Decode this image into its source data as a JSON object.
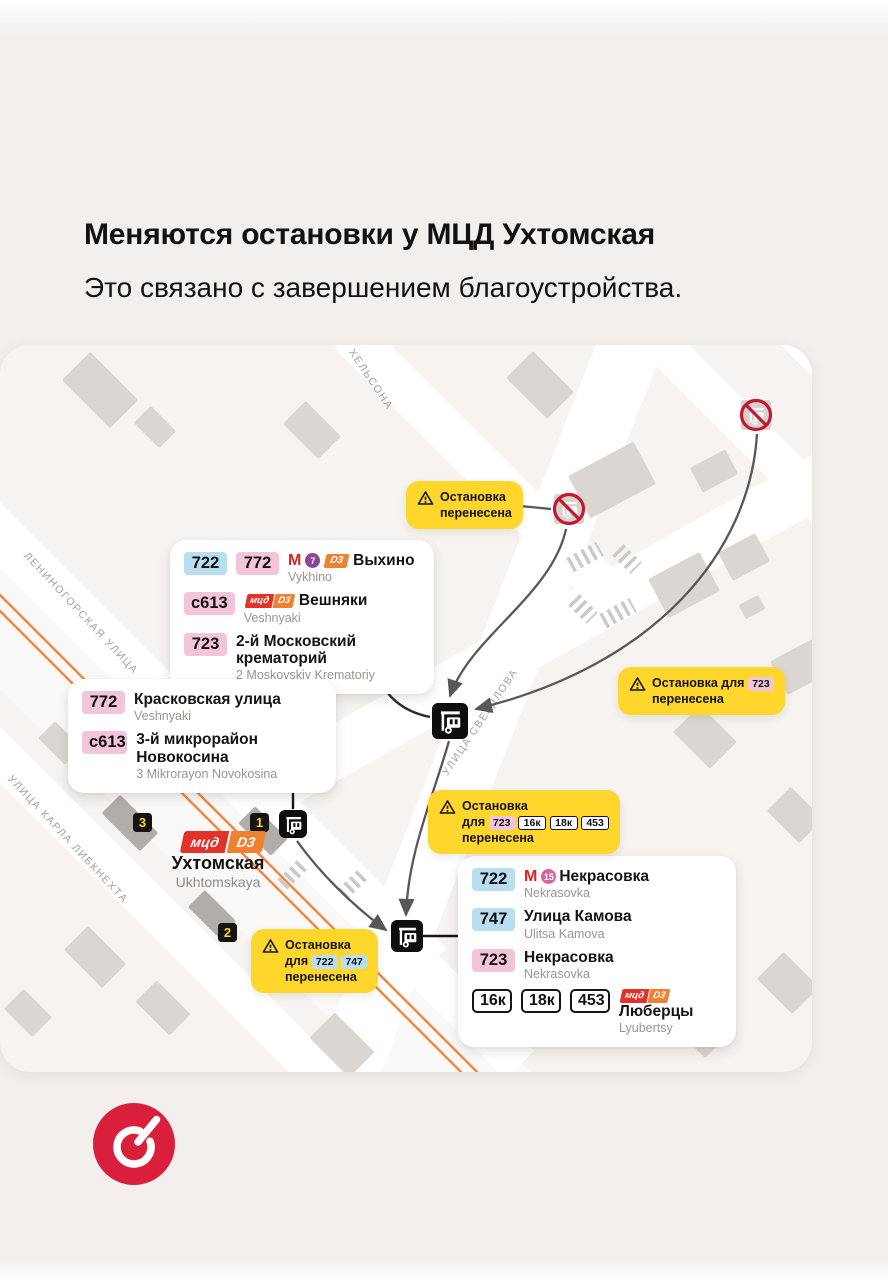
{
  "colors": {
    "yellow": "#ffd62b",
    "badge_blue": "#b9ddf1",
    "badge_pink": "#f3c5da",
    "metro_red": "#e0211f",
    "line7_purple": "#8d4796",
    "line15_pink": "#d9639f",
    "mcd_red": "#e2332b",
    "d3_orange": "#ee8230",
    "railway_orange": "#ef8740",
    "arrow_gray": "#5a5856",
    "logo_red": "#d91f3c"
  },
  "page": {
    "title": "Меняются остановки у МЦД Ухтомская",
    "subtitle": "Это связано с завершением благоустройства."
  },
  "metro": {
    "m": "М"
  },
  "station": {
    "mcd": "мцд",
    "line": "D3",
    "name": "Ухтомская",
    "name_latin": "Ukhtomskaya"
  },
  "markers": {
    "m1": "1",
    "m2": "2",
    "m3": "3"
  },
  "streets": {
    "leninogorskaya": "ЛЕНИНОГОРСКАЯ УЛИЦА",
    "karla_libknehta": "УЛИЦА КАРЛА ЛИБКНЕХТА",
    "khelsona": "ХЕЛЬСОНА",
    "sverdlova": "УЛИЦА СВЕРДЛОВА"
  },
  "callouts": {
    "vykhino": {
      "rows": [
        {
          "badge1": "722",
          "badge2": "772",
          "line_num": "7",
          "d3": "D3",
          "title": "Выхино",
          "sub": "Vykhino"
        },
        {
          "badge1": "с613",
          "mcd": "мцд",
          "d3": "D3",
          "title": "Вешняки",
          "sub": "Veshnyaki"
        },
        {
          "badge1": "723",
          "title": "2-й Московский крематорий",
          "sub": "2 Moskovskiy Krematoriy"
        }
      ]
    },
    "kraskovskaya": {
      "rows": [
        {
          "badge1": "772",
          "title": "Красковская улица",
          "sub": "Veshnyaki"
        },
        {
          "badge1": "с613",
          "title": "3-й микрорайон Новокосина",
          "sub": "3 Mikrorayon Novokosina"
        }
      ]
    },
    "nekrasovka": {
      "rows": [
        {
          "badge1": "722",
          "line_num": "15",
          "title": "Некрасовка",
          "sub": "Nekrasovka"
        },
        {
          "badge1": "747",
          "title": "Улица Камова",
          "sub": "Ulitsa Kamova"
        },
        {
          "badge1": "723",
          "title": "Некрасовка",
          "sub": "Nekrasovka"
        },
        {
          "badge1": "16к",
          "badge2": "18к",
          "badge3": "453",
          "mcd": "мцд",
          "d3": "D3",
          "title": "Люберцы",
          "sub": "Lyubertsy"
        }
      ]
    }
  },
  "warnings": {
    "w1": {
      "line1": "Остановка",
      "line2": "перенесена"
    },
    "w2": {
      "line1": "Остановка для",
      "badge1": "723",
      "line2": "перенесена"
    },
    "w3": {
      "line1": "Остановка",
      "pre": "для",
      "badge1": "723",
      "badge2": "16к",
      "badge3": "18к",
      "badge4": "453",
      "line3": "перенесена"
    },
    "w4": {
      "line1": "Остановка",
      "pre": "для",
      "badge1": "722",
      "badge2": "747",
      "line3": "перенесена"
    }
  }
}
